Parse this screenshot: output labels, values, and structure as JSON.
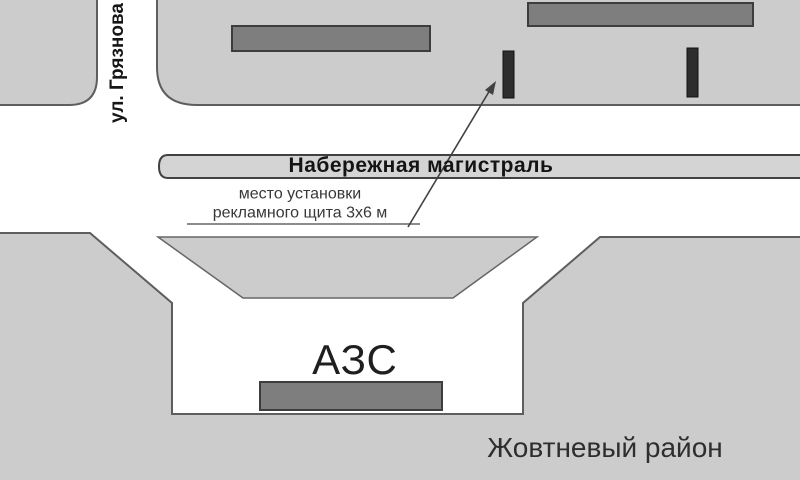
{
  "map": {
    "street_label": "ул. Грязнова",
    "highway_label": "Набережная магистраль",
    "annotation_line1": "место установки",
    "annotation_line2": "рекламного щита 3х6 м",
    "gas_station_label": "АЗС",
    "district_label": "Жовтневый район"
  },
  "colors": {
    "background": "#ffffff",
    "area_fill": "#cccccc",
    "strip_fill": "#d4d4d4",
    "building_fill": "#7e7e7e",
    "billboard_marker_fill": "#2d2d2d",
    "arrow_color": "#414141",
    "underline_color": "#8c8c8c"
  }
}
